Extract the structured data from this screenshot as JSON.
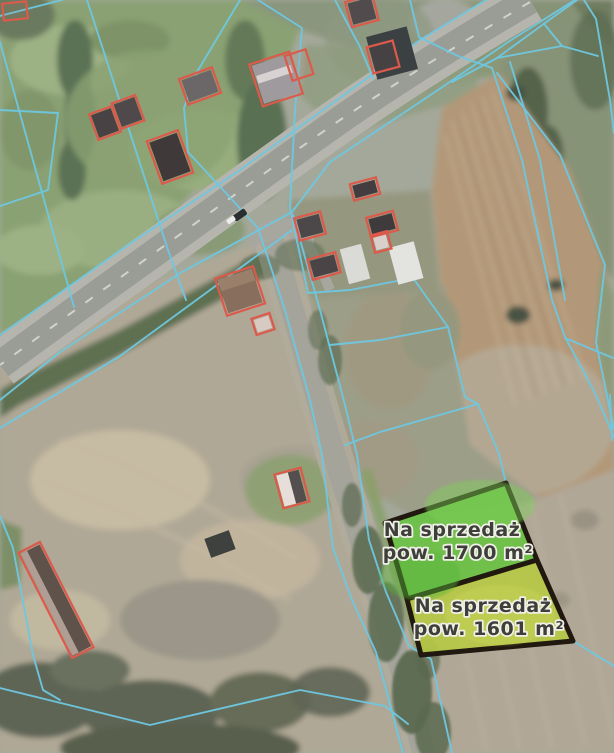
{
  "map": {
    "description": "Aerial cadastral map with two highlighted parcels for sale",
    "parcels_for_sale": [
      {
        "id": "parcel-1700",
        "line1": "Na sprzedaż",
        "line2": "pow. 1700 m²",
        "area_label": "1700 m²",
        "fill": "#68c341"
      },
      {
        "id": "parcel-1601",
        "line1": "Na sprzedaż",
        "line2": "pow. 1601 m²",
        "area_label": "1601 m²",
        "fill": "#b7c944"
      }
    ],
    "colors": {
      "cadastral_line": "#6ec8e1",
      "building_outline": "#dc5a4b",
      "parcel_border": "#211910",
      "label_text": "#3e3e3a",
      "label_halo": "#f0f0e8"
    }
  }
}
